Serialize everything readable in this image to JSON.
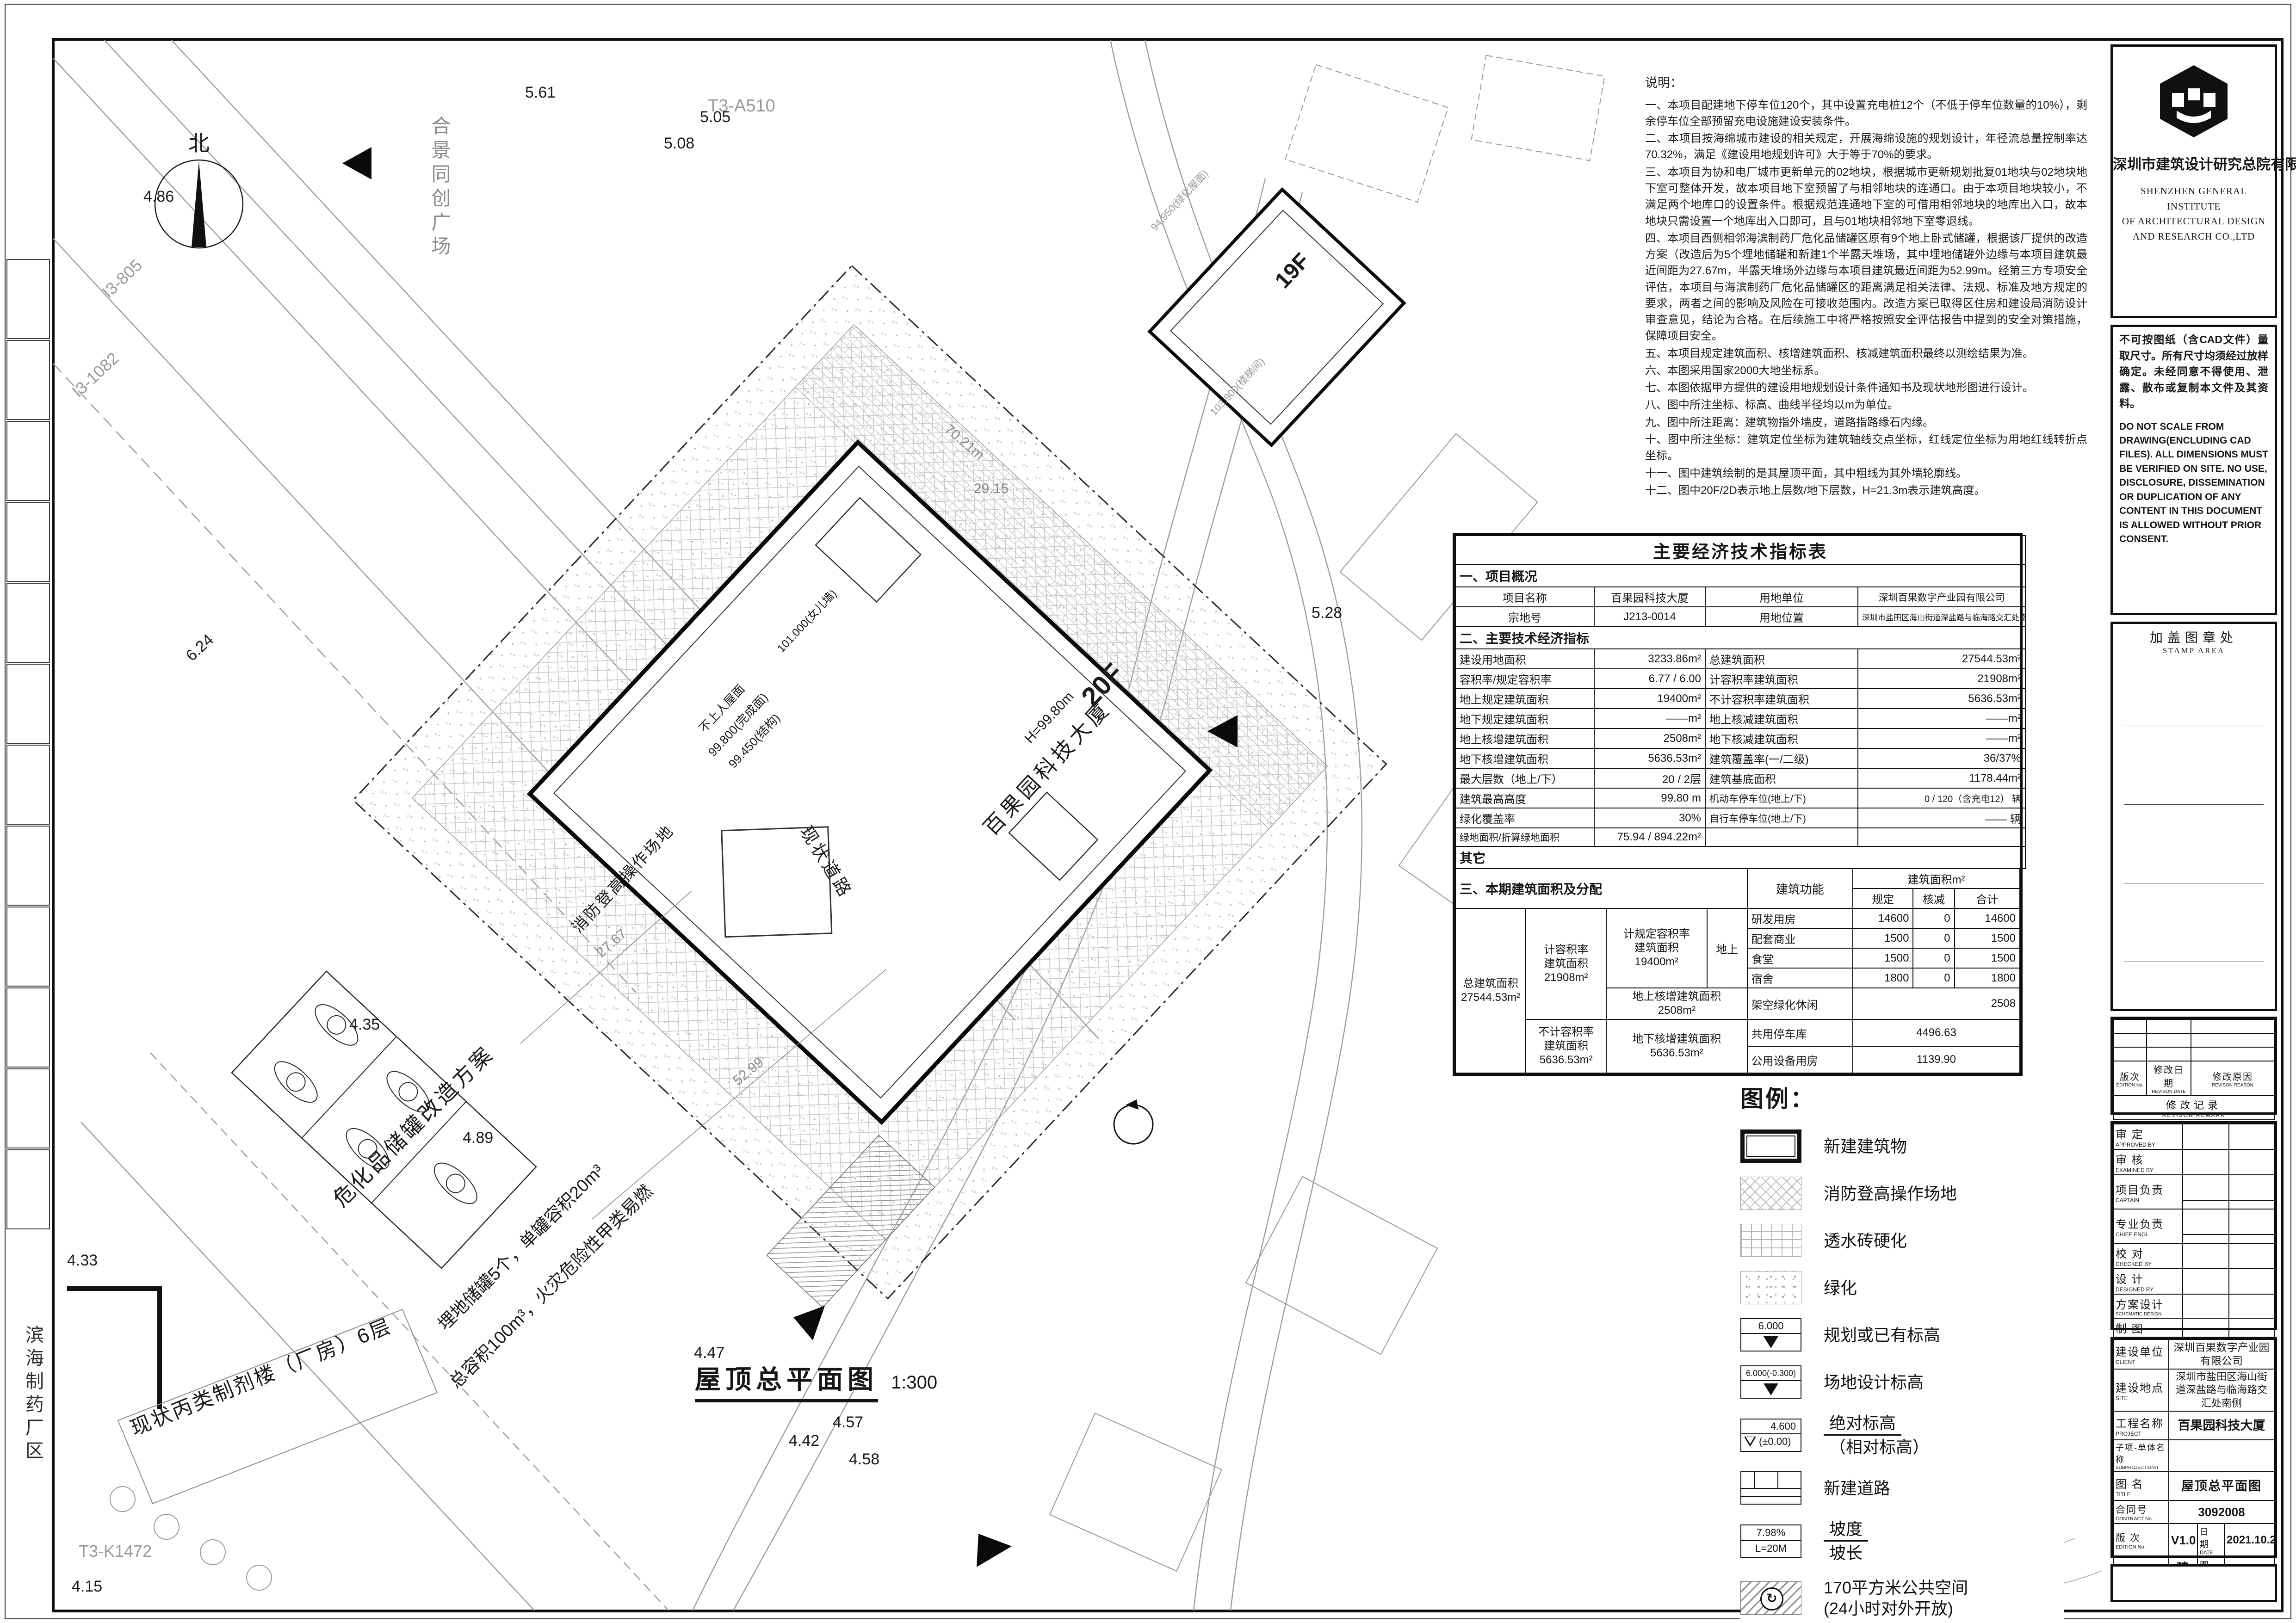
{
  "colors": {
    "ink": "#111111",
    "muted": "#9a9a9a"
  },
  "plan": {
    "north": "北",
    "title": "屋顶总平面图",
    "scale": "1:300",
    "building_name": "百果园科技大厦",
    "building_floors": "20F",
    "building_height": "H=99.80m",
    "adjacent_floors": "19F",
    "roof_label_1": "不上人屋面",
    "roof_label_2": "99.800(完成面)",
    "roof_label_3": "99.450(结构)",
    "roof_label_4": "101.000(女儿墙)",
    "roof_label_5": "94.950(绿化屋面)",
    "roof_label_6": "103.900(楼梯间)",
    "fire_site_label": "消防登高操作场地",
    "tank_title": "危化品储罐改造方案",
    "tank_line1": "埋地储罐5个，单罐容积20m³",
    "tank_line2": "总容积100m³，火灾危险性甲类易燃",
    "pharma_building": "现状丙类制剂楼（厂房）6层",
    "pharma_area": "滨海制药厂区",
    "existing_road": "现状道路",
    "plaza": "合景同创广场",
    "dim_52": "52.99",
    "dim_27": "27.67",
    "dim_70": "70.21m",
    "dim_29": "29.15",
    "ref_1": "T3-A510",
    "ref_2": "I3-805",
    "ref_3": "I3-1082",
    "ref_4": "T3-K1472",
    "elev_1": "5.61",
    "elev_2": "5.08",
    "elev_3": "5.05",
    "elev_4": "4.86",
    "elev_5": "6.24",
    "elev_6": "5.28",
    "elev_7": "4.35",
    "elev_8": "4.33",
    "elev_9": "4.47",
    "elev_10": "4.42",
    "elev_11": "4.57",
    "elev_12": "4.58",
    "elev_13": "4.89",
    "elev_14": "4.15"
  },
  "notes": {
    "title": "说明：",
    "items": [
      "一、本项目配建地下停车位120个，其中设置充电桩12个（不低于停车位数量的10%），剩余停车位全部预留充电设施建设安装条件。",
      "二、本项目按海绵城市建设的相关规定，开展海绵设施的规划设计，年径流总量控制率达70.32%，满足《建设用地规划许可》大于等于70%的要求。",
      "三、本项目为协和电厂城市更新单元的02地块，根据城市更新规划批复01地块与02地块地下室可整体开发，故本项目地下室预留了与相邻地块的连通口。由于本项目地块较小，不满足两个地库口的设置条件。根据规范连通地下室的可借用相邻地块的地库出入口，故本地块只需设置一个地库出入口即可，且与01地块相邻地下室零退线。",
      "四、本项目西侧相邻海滨制药厂危化品储罐区原有9个地上卧式储罐，根据该厂提供的改造方案（改造后为5个埋地储罐和新建1个半露天堆场，其中埋地储罐外边缘与本项目建筑最近间距为27.67m，半露天堆场外边缘与本项目建筑最近间距为52.99m。经第三方专项安全评估，本项目与海滨制药厂危化品储罐区的距离满足相关法律、法规、标准及地方规定的要求，两者之间的影响及风险在可接收范围内。改造方案已取得区住房和建设局消防设计审查意见，结论为合格。在后续施工中将严格按照安全评估报告中提到的安全对策措施，保障项目安全。",
      "五、本项目规定建筑面积、核增建筑面积、核减建筑面积最终以测绘结果为准。",
      "六、本图采用国家2000大地坐标系。",
      "七、本图依据甲方提供的建设用地规划设计条件通知书及现状地形图进行设计。",
      "八、图中所注坐标、标高、曲线半径均以m为单位。",
      "九、图中所注距离：建筑物指外墙皮，道路指路缘石内缘。",
      "十、图中所注坐标：建筑定位坐标为建筑轴线交点坐标，红线定位坐标为用地红线转折点坐标。",
      "十一、图中建筑绘制的是其屋顶平面，其中粗线为其外墙轮廓线。",
      "十二、图中20F/2D表示地上层数/地下层数，H=21.3m表示建筑高度。"
    ]
  },
  "indicators": {
    "title": "主要经济技术指标表",
    "sec1": "一、项目概况",
    "rows1": [
      {
        "l1": "项目名称",
        "v1": "百果园科技大厦",
        "l2": "用地单位",
        "v2": "深圳百果数字产业园有限公司"
      },
      {
        "l1": "宗地号",
        "v1": "J213-0014",
        "l2": "用地位置",
        "v2": "深圳市盐田区海山街道深盐路与临海路交汇处南侧"
      }
    ],
    "sec2": "二、主要技术经济指标",
    "rows2": [
      {
        "l1": "建设用地面积",
        "v1": "3233.86m²",
        "l2": "总建筑面积",
        "v2": "27544.53m²"
      },
      {
        "l1": "容积率/规定容积率",
        "v1": "6.77 / 6.00",
        "l2": "计容积率建筑面积",
        "v2": "21908m²"
      },
      {
        "l1": "地上规定建筑面积",
        "v1": "19400m²",
        "l2": "不计容积率建筑面积",
        "v2": "5636.53m²"
      },
      {
        "l1": "地下规定建筑面积",
        "v1": "——m²",
        "l2": "地上核减建筑面积",
        "v2": "——m²"
      },
      {
        "l1": "地上核增建筑面积",
        "v1": "2508m²",
        "l2": "地下核减建筑面积",
        "v2": "——m²"
      },
      {
        "l1": "地下核增建筑面积",
        "v1": "5636.53m²",
        "l2": "建筑覆盖率(一/二级)",
        "v2": "36/37%"
      },
      {
        "l1": "最大层数（地上/下）",
        "v1": "20 / 2层",
        "l2": "建筑基底面积",
        "v2": "1178.44m²"
      },
      {
        "l1": "建筑最高高度",
        "v1": "99.80 m",
        "l2": "机动车停车位(地上/下)",
        "v2": "0 / 120（含充电12） 辆"
      },
      {
        "l1": "绿化覆盖率",
        "v1": "30%",
        "l2": "自行车停车位(地上/下)",
        "v2": "—— 辆"
      },
      {
        "l1": "绿地面积/折算绿地面积",
        "v1": "75.94 / 894.22m²",
        "l2": "",
        "v2": ""
      }
    ],
    "other": "其它",
    "sec3": {
      "title": "三、本期建筑面积及分配",
      "func": "建筑功能",
      "area_m2": "建筑面积m²",
      "h_spec": "规定",
      "h_ded": "核减",
      "h_tot": "合计",
      "total_l1": "总建筑面积",
      "total_l2": "27544.53m²",
      "incl_l1": "计容积率",
      "incl_l2": "建筑面积",
      "incl_l3": "21908m²",
      "spec_l1": "计规定容积率",
      "spec_l2": "建筑面积",
      "spec_l3": "19400m²",
      "above": "地上",
      "above_add_l1": "地上核增建筑面积",
      "above_add_l2": "2508m²",
      "excl_l1": "不计容积率",
      "excl_l2": "建筑面积",
      "excl_l3": "5636.53m²",
      "below_add_l1": "地下核增建筑面积",
      "below_add_l2": "5636.53m²",
      "rows_above": [
        {
          "name": "研发用房",
          "spec": "14600",
          "ded": "0",
          "tot": "14600"
        },
        {
          "name": "配套商业",
          "spec": "1500",
          "ded": "0",
          "tot": "1500"
        },
        {
          "name": "食堂",
          "spec": "1500",
          "ded": "0",
          "tot": "1500"
        },
        {
          "name": "宿舍",
          "spec": "1800",
          "ded": "0",
          "tot": "1800"
        }
      ],
      "row_green": {
        "name": "架空绿化休闲",
        "tot": "2508"
      },
      "row_park": {
        "name": "共用停车库",
        "tot": "4496.63"
      },
      "row_equip": {
        "name": "公用设备用房",
        "tot": "1139.90"
      }
    }
  },
  "legend": {
    "title": "图例：",
    "items": [
      {
        "label": "新建建筑物"
      },
      {
        "label": "消防登高操作场地"
      },
      {
        "label": "透水砖硬化"
      },
      {
        "label": "绿化"
      },
      {
        "label": "规划或已有标高",
        "val": "6.000"
      },
      {
        "label": "场地设计标高",
        "val": "6.000(-0.300)"
      },
      {
        "label": "绝对标高",
        "label2": "（相对标高）",
        "val": "4.600",
        "val2": "(±0.00)"
      },
      {
        "label": "新建道路"
      },
      {
        "label": "坡度",
        "label2": "坡长",
        "val": "7.98%",
        "val2": "L=20M"
      },
      {
        "label": "170平方米公共空间",
        "label2": "(24小时对外开放)"
      },
      {
        "label": "出入口"
      }
    ]
  },
  "titleblock": {
    "company_cn": "深圳市建筑设计研究总院有限公司",
    "company_en1": "SHENZHEN GENERAL INSTITUTE",
    "company_en2": "OF ARCHITECTURAL DESIGN",
    "company_en3": "AND RESEARCH CO.,LTD",
    "disclaimer_cn": "不可按图纸（含CAD文件）量取尺寸。所有尺寸均须经过放样确定。未经同意不得使用、泄露、散布或复制本文件及其资料。",
    "disclaimer_en": "DO NOT SCALE FROM DRAWING(ENCLUDING CAD FILES). ALL DIMENSIONS MUST BE VERIFIED ON SITE. NO USE, DISCLOSURE, DISSEMINATION OR DUPLICATION OF ANY CONTENT IN THIS DOCUMENT IS ALLOWED WITHOUT PRIOR CONSENT.",
    "stamp_cn": "加盖图章处",
    "stamp_en": "STAMP AREA",
    "rev": {
      "edition_cn": "版次",
      "edition_en": "EDITION No.",
      "date_cn": "修改日期",
      "date_en": "REVISON DATE",
      "reason_cn": "修改原因",
      "reason_en": "REVISON REASON",
      "remark_cn": "修改记录",
      "remark_en": "REVISON REMARK"
    },
    "sign_rows": [
      {
        "cn": "审  定",
        "en": "APPROVED BY"
      },
      {
        "cn": "审  核",
        "en": "EXAMINED BY"
      },
      {
        "cn": "项目负责",
        "en": "CAPTAIN"
      },
      {
        "cn": "专业负责",
        "en": "CHIEF ENGI."
      },
      {
        "cn": "校  对",
        "en": "CHECKED BY"
      },
      {
        "cn": "设  计",
        "en": "DESIGNED BY"
      },
      {
        "cn": "方案设计",
        "en": "SCHEMATIC DESIGN"
      },
      {
        "cn": "制  图",
        "en": "DRAWN BY"
      }
    ],
    "print_cn": "印刷体",
    "print_en": "PRINT",
    "sig_cn": "签  署",
    "sig_en": "SIGNATURE",
    "info": [
      {
        "cn": "建设单位",
        "en": "CLIENT",
        "val": "深圳百果数字产业园有限公司"
      },
      {
        "cn": "建设地点",
        "en": "SITE",
        "val": "深圳市盐田区海山街道深盐路与临海路交汇处南侧"
      },
      {
        "cn": "工程名称",
        "en": "PROJECT",
        "val": "百果园科技大厦"
      },
      {
        "cn": "子项-单体名称",
        "en": "SUBPROJECT-UNIT",
        "val": ""
      },
      {
        "cn": "图  名",
        "en": "TITLE",
        "val": "屋顶总平面图"
      },
      {
        "cn": "合同号",
        "en": "CONTRACT No.",
        "val": "3092008"
      }
    ],
    "edition_cn": "版  次",
    "edition_en": "EDITION No.",
    "edition_val": "V1.0",
    "date_cn": "日  期",
    "date_en": "DATE",
    "date_val": "2021.10.20",
    "type_cn": "图  别",
    "type_en": "DRAWING TYPE",
    "type_val": "建施",
    "dwgno_cn": "图  号",
    "dwgno_en": "DRAWING No.",
    "dwgno_val": "JS-Z-01"
  }
}
